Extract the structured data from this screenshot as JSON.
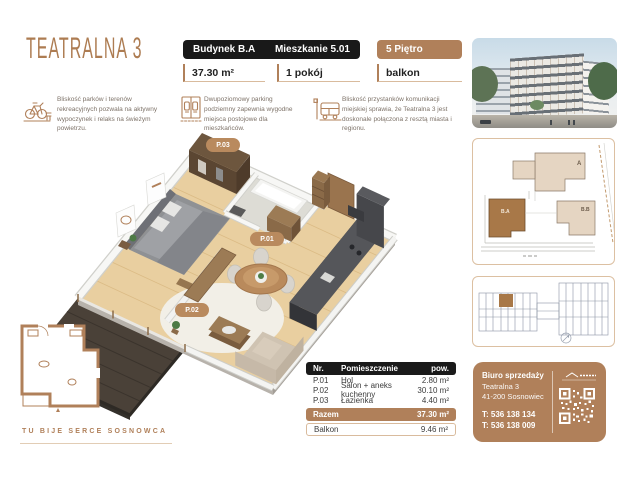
{
  "brand": {
    "logo": "TEATRALNA 3",
    "tagline": "TU BIJE SERCE SOSNOWCA",
    "accent_color": "#b0805a",
    "badge_black_color": "#191919"
  },
  "header": {
    "building_label": "Budynek B.A",
    "apartment_label": "Mieszkanie 5.01",
    "floor_label": "5 Piętro",
    "specs": [
      {
        "label": "37.30 m²"
      },
      {
        "label": "1 pokój"
      },
      {
        "label": "balkon"
      }
    ]
  },
  "features": [
    {
      "icon": "park-bicycle-icon",
      "text": "Bliskość parków i terenów rekreacyjnych pozwala na aktywny wypoczynek i relaks na świeżym powietrzu."
    },
    {
      "icon": "underground-parking-icon",
      "text": "Dwupoziomowy parking podziemny zapewnia wygodne miejsca postojowe dla mieszkańców."
    },
    {
      "icon": "bus-icon",
      "text": "Bliskość przystanków komunikacji miejskiej sprawia, że Teatralna 3 jest doskonale połączona z resztą miasta i regionu."
    }
  ],
  "floorplan": {
    "p01": "P.01",
    "p02": "P.02",
    "p03": "P.03"
  },
  "site_plan": {
    "building_a": "A",
    "building_bb": "B.B",
    "building_ba": "B.A",
    "highlighted": "B.A"
  },
  "rooms_table": {
    "headers": {
      "nr": "Nr.",
      "name": "Pomieszczenie",
      "area": "pow."
    },
    "rows": [
      {
        "nr": "P.01",
        "name": "Hol",
        "area": "2.80 m²"
      },
      {
        "nr": "P.02",
        "name": "Salon + aneks kuchenny",
        "area": "30.10 m²"
      },
      {
        "nr": "P.03",
        "name": "Łazienka",
        "area": "4.40 m²"
      }
    ],
    "total": {
      "name": "Razem",
      "area": "37.30 m²"
    },
    "extra": {
      "name": "Balkon",
      "area": "9.46 m²"
    }
  },
  "sales_office": {
    "title": "Biuro sprzedaży",
    "address_line1": "Teatralna 3",
    "address_line2": "41-200 Sosnowiec",
    "phone1": "T: 536 138 134",
    "phone2": "T: 536 138 009"
  }
}
